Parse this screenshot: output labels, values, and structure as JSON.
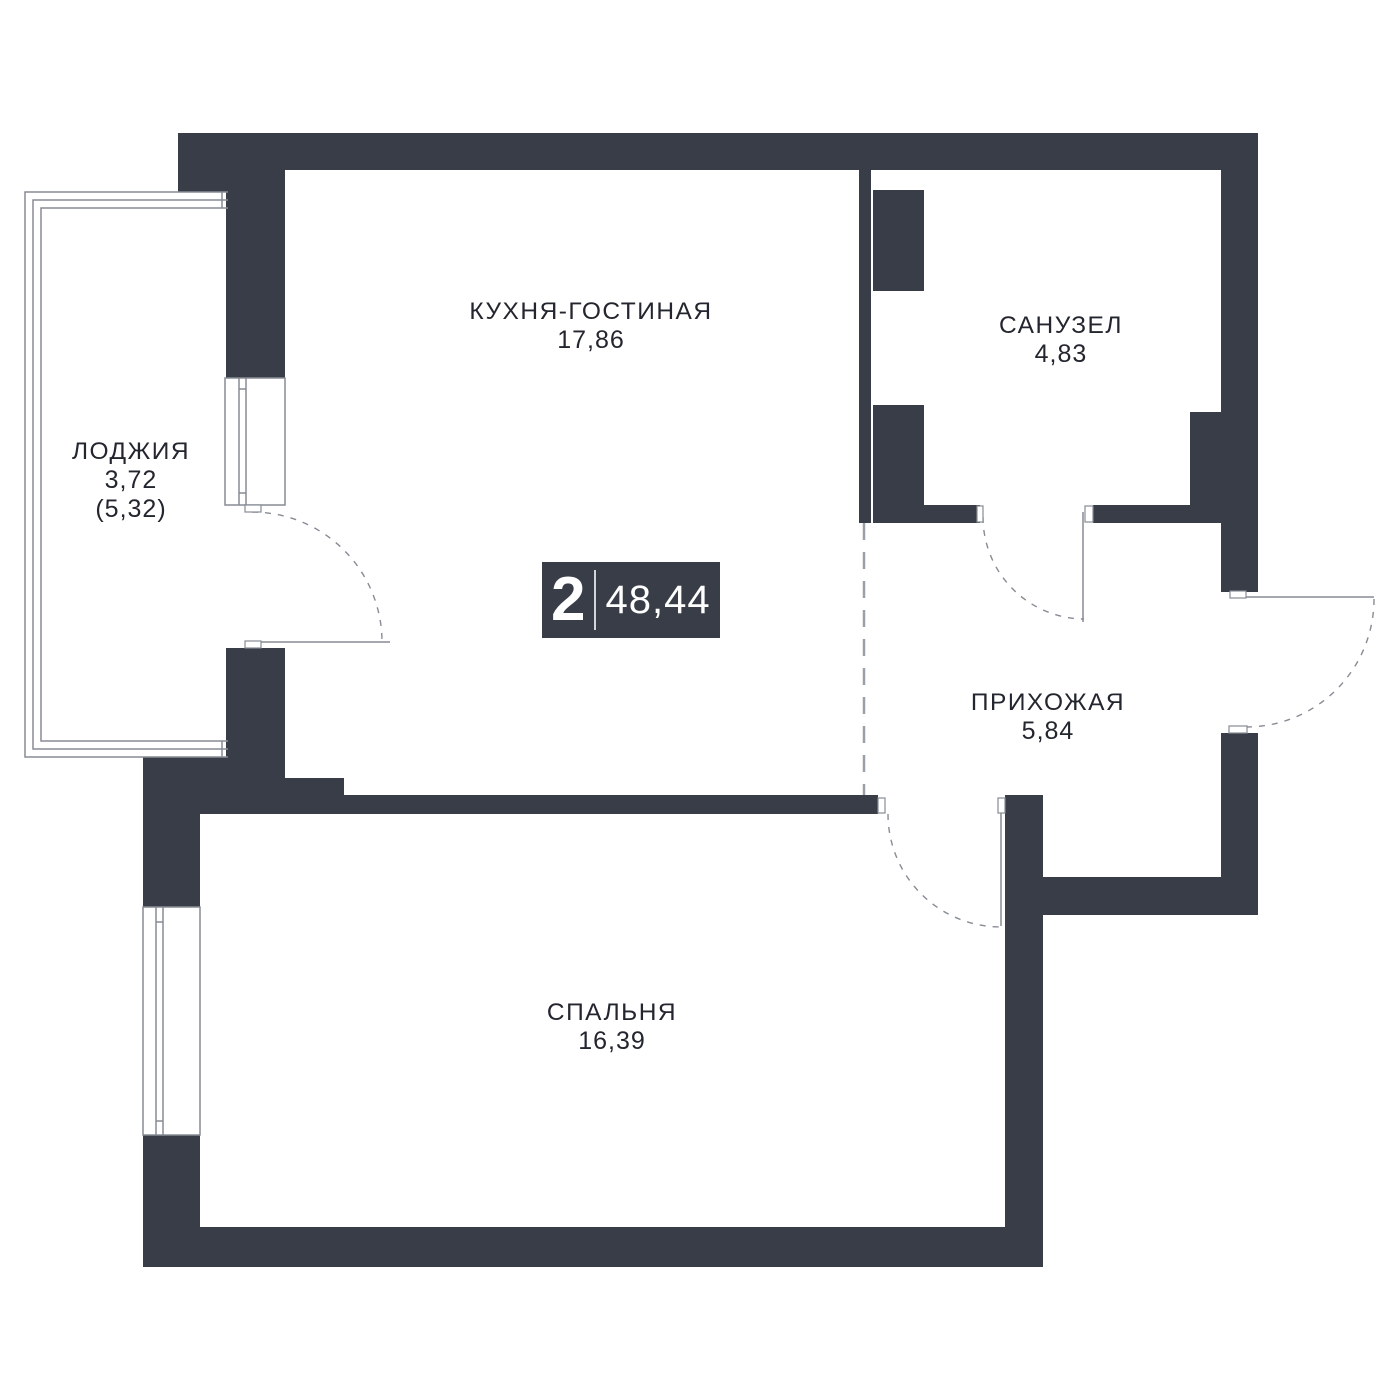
{
  "badge": {
    "rooms_count": "2",
    "total_area": "48,44"
  },
  "rooms": {
    "kitchen": {
      "name": "КУХНЯ-ГОСТИНАЯ",
      "area": "17,86"
    },
    "bathroom": {
      "name": "САНУЗЕЛ",
      "area": "4,83"
    },
    "loggia": {
      "name": "ЛОДЖИЯ",
      "area": "3,72",
      "area_full": "(5,32)"
    },
    "hallway": {
      "name": "ПРИХОЖАЯ",
      "area": "5,84"
    },
    "bedroom": {
      "name": "СПАЛЬНЯ",
      "area": "16,39"
    }
  },
  "colors": {
    "wall": "#383d47",
    "line": "#878b94",
    "dash": "#9aa0a8",
    "text": "#23262e",
    "badge_bg": "#383d47",
    "badge_divider": "#d2d5da",
    "fill_white": "#ffffff"
  }
}
